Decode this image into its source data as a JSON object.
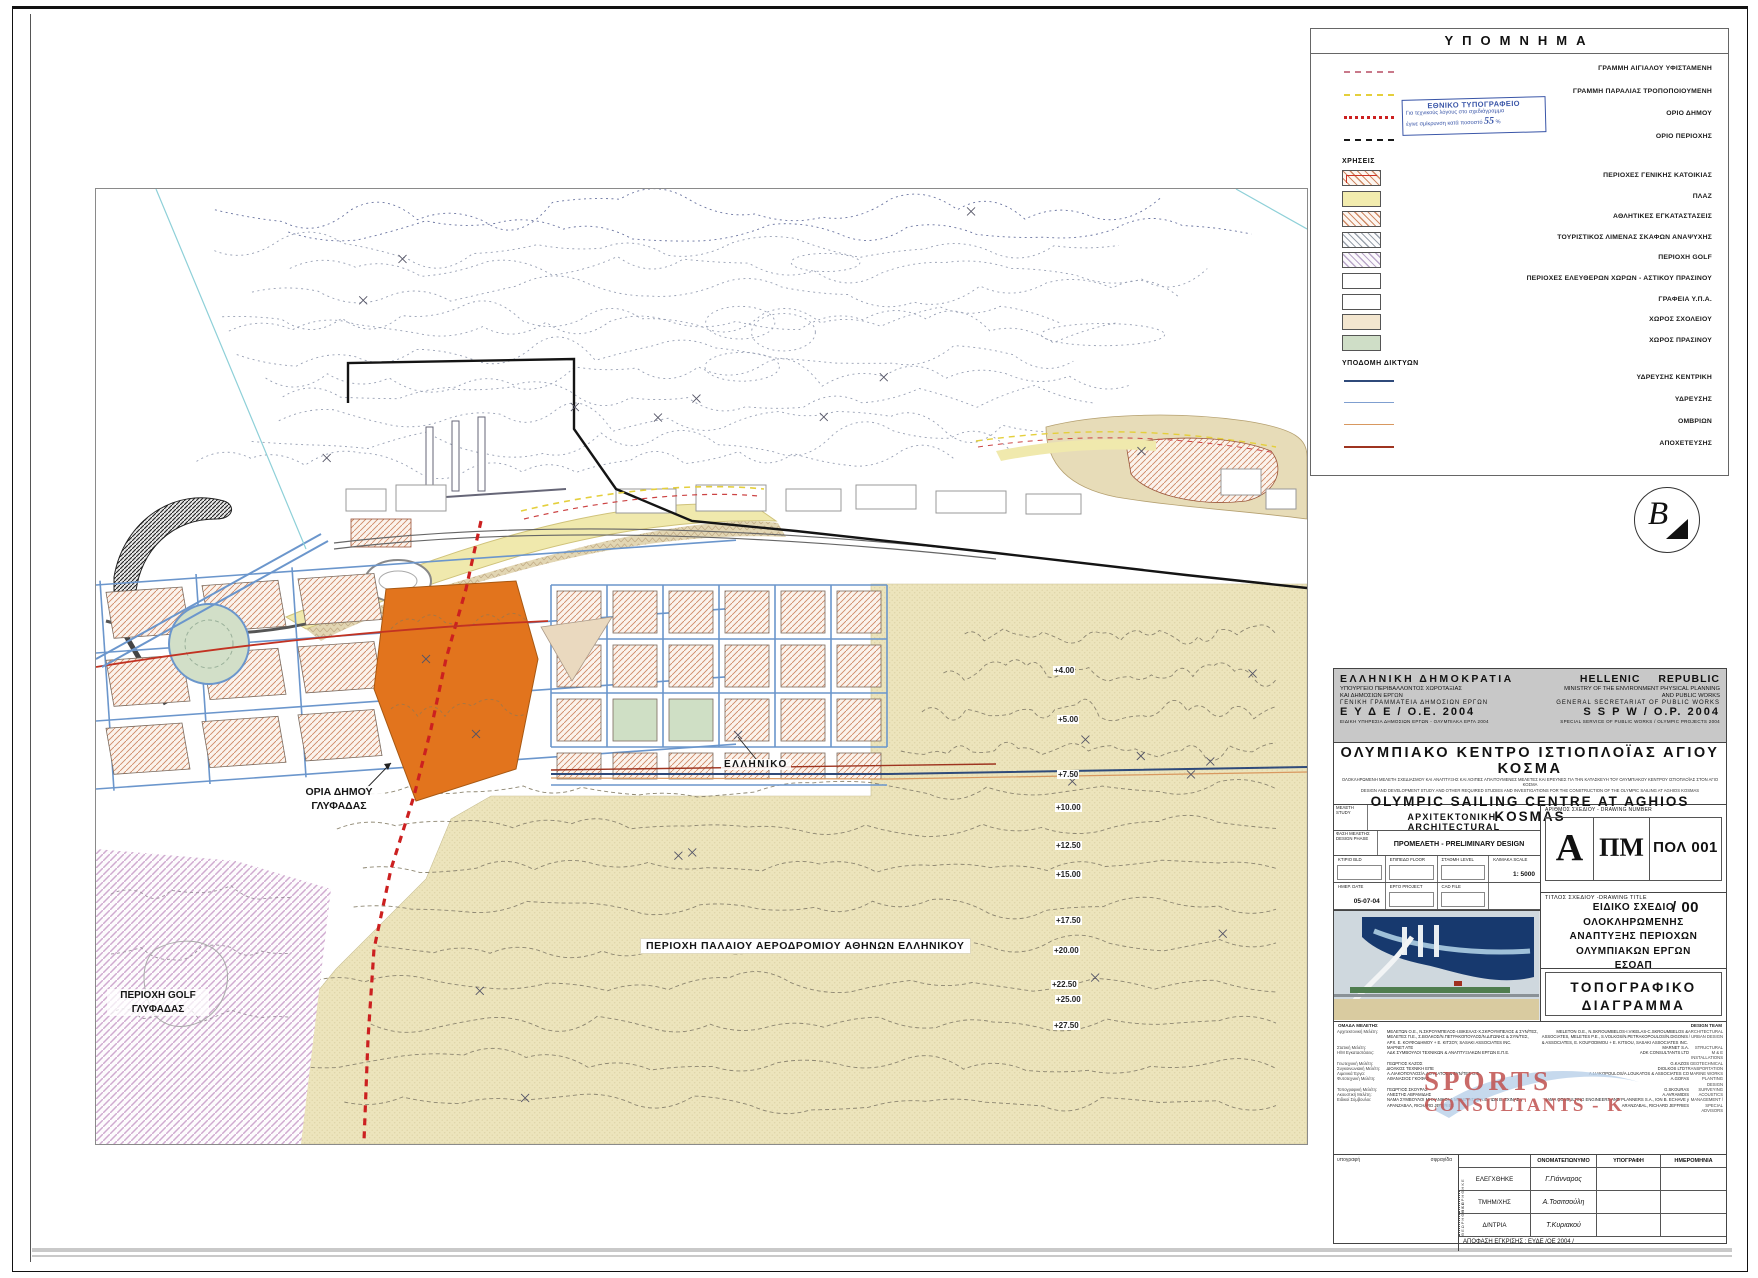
{
  "colors": {
    "accent_orange": "#e2741d",
    "stamp_blue": "#3a56a8",
    "logo_red": "#c0504d",
    "tan_area": "#ece4bc",
    "hatch_salmon": "#cf8a66",
    "street_blue": "#6b96cc",
    "boundary_red": "#cc2020"
  },
  "legend": {
    "title": "ΥΠΟΜΝΗΜΑ",
    "lines": [
      {
        "kind": "aigialos",
        "label": "ΓΡΑΜΜΗ ΑΙΓΙΑΛΟΥ ΥΦΙΣΤΑΜΕΝΗ"
      },
      {
        "kind": "paralia",
        "label": "ΓΡΑΜΜΗ ΠΑΡΑΛΙΑΣ ΤΡΟΠΟΠΟΙΟΥΜΕΝΗ"
      },
      {
        "kind": "dimou",
        "label": "ΟΡΙΟ ΔΗΜΟΥ"
      },
      {
        "kind": "periochis",
        "label": "ΟΡΙΟ ΠΕΡΙΟΧΗΣ"
      }
    ],
    "uses_title": "ΧΡΗΣΕΙΣ",
    "uses": [
      {
        "kind": "residential",
        "label": "ΠΕΡΙΟΧΕΣ ΓΕΝΙΚΗΣ ΚΑΤΟΙΚΙΑΣ"
      },
      {
        "kind": "plaz",
        "label": "ΠΛΑΖ"
      },
      {
        "kind": "sport",
        "label": "ΑΘΛΗΤΙΚΕΣ ΕΓΚΑΤΑΣΤΑΣΕΙΣ"
      },
      {
        "kind": "marina",
        "label": "ΤΟΥΡΙΣΤΙΚΟΣ ΛΙΜΕΝΑΣ ΣΚΑΦΩΝ ΑΝΑΨΥΧΗΣ"
      },
      {
        "kind": "golf",
        "label": "ΠΕΡΙΟΧΗ GOLF"
      },
      {
        "kind": "freespace",
        "label": "ΠΕΡΙΟΧΕΣ ΕΛΕΥΘΕΡΩΝ ΧΩΡΩΝ - ΑΣΤΙΚΟΥ ΠΡΑΣΙΝΟΥ"
      },
      {
        "kind": "ypa",
        "label": "ΓΡΑΦΕΙΑ Υ.Π.Α."
      },
      {
        "kind": "school",
        "label": "ΧΩΡΟΣ ΣΧΟΛΕΙΟΥ"
      },
      {
        "kind": "green",
        "label": "ΧΩΡΟΣ ΠΡΑΣΙΝΟΥ"
      }
    ],
    "networks_title": "ΥΠΟΔΟΜΗ ΔΙΚΤΥΩΝ",
    "networks": [
      {
        "kind": "water-main",
        "label": "ΥΔΡΕΥΣΗΣ ΚΕΝΤΡΙΚΗ"
      },
      {
        "kind": "water",
        "label": "ΥΔΡΕΥΣΗΣ"
      },
      {
        "kind": "storm",
        "label": "ΟΜΒΡΙΩΝ"
      },
      {
        "kind": "sewer",
        "label": "ΑΠΟΧΕΤΕΥΣΗΣ"
      }
    ]
  },
  "stamp": {
    "line1": "ΕΘΝΙΚΟ ΤΥΠΟΓΡΑΦΕΙΟ",
    "line2": "Για τεχνικούς λόγους στο σχεδιάγραμμα",
    "line3": "έγινε σμίκρυνση κατά ποσοστό",
    "value": "55",
    "percent": "%"
  },
  "logo_b": "B",
  "map": {
    "labels": {
      "oria1": "ΟΡΙΑ ΔΗΜΟΥ",
      "oria2": "ΓΛΥΦΑΔΑΣ",
      "elliniko": "ΕΛΛΗΝΙΚΟ",
      "airport": "ΠΕΡΙΟΧΗ ΠΑΛΑΙΟΥ ΑΕΡΟΔΡΟΜΙΟΥ ΑΘΗΝΩΝ ΕΛΛΗΝΙΚΟΥ",
      "golf1": "ΠΕΡΙΟΧΗ GOLF",
      "golf2": "ΓΛΥΦΑΔΑΣ"
    },
    "elevations": [
      {
        "label": "+4.00",
        "x": 958,
        "y": 478
      },
      {
        "label": "+5.00",
        "x": 962,
        "y": 527
      },
      {
        "label": "+7.50",
        "x": 962,
        "y": 582
      },
      {
        "label": "+10.00",
        "x": 960,
        "y": 615
      },
      {
        "label": "+12.50",
        "x": 960,
        "y": 653
      },
      {
        "label": "+15.00",
        "x": 960,
        "y": 682
      },
      {
        "label": "+17.50",
        "x": 960,
        "y": 728
      },
      {
        "label": "+20.00",
        "x": 958,
        "y": 758
      },
      {
        "label": "+22.50",
        "x": 956,
        "y": 792
      },
      {
        "label": "+25.00",
        "x": 960,
        "y": 807
      },
      {
        "label": "+27.50",
        "x": 958,
        "y": 833
      }
    ]
  },
  "tb": {
    "gr": {
      "l1": "ΕΛΛΗΝΙΚΗ ΔΗΜΟΚΡΑΤΙΑ",
      "l2": "ΥΠΟΥΡΓΕΙΟ ΠΕΡΙΒΑΛΛΟΝΤΟΣ ΧΩΡΟΤΑΞΙΑΣ",
      "l3": "ΚΑΙ ΔΗΜΟΣΙΩΝ ΕΡΓΩΝ",
      "l4": "ΓΕΝΙΚΗ ΓΡΑΜΜΑΤΕΙΑ ΔΗΜΟΣΙΩΝ ΕΡΓΩΝ",
      "l5": "Ε Υ Δ Ε / Ο.Ε. 2004",
      "l6": "ΕΙΔΙΚΗ ΥΠΗΡΕΣΙΑ ΔΗΜΟΣΙΩΝ ΕΡΓΩΝ - ΟΛΥΜΠΙΑΚΑ ΕΡΓΑ 2004"
    },
    "en": {
      "l1": "HELLENIC REPUBLIC",
      "l2": "MINISTRY OF THE ENVIRONMENT PHYSICAL PLANNING",
      "l3": "AND PUBLIC WORKS",
      "l4": "GENERAL SECRETARIAT OF PUBLIC WORKS",
      "l5": "S S P W  /  O.P. 2004",
      "l6": "SPECIAL SERVICE OF PUBLIC WORKS / OLYMPIC PROJECTS 2004"
    },
    "project_gr": "ΟΛΥΜΠΙΑΚΟ ΚΕΝΤΡΟ ΙΣΤΙΟΠΛΟΪΑΣ ΑΓΙΟΥ ΚΟΣΜΑ",
    "sub_gr": "ΟΛΟΚΛΗΡΩΜΕΝΗ ΜΕΛΕΤΗ ΣΧΕΔΙΑΣΜΟΥ ΚΑΙ ΑΝΑΠΤΥΞΗΣ ΚΑΙ ΛΟΙΠΕΣ ΑΠΑΙΤΟΥΜΕΝΕΣ ΜΕΛΕΤΕΣ ΚΑΙ ΕΡΕΥΝΕΣ ΓΙΑ ΤΗΝ ΚΑΤΑΣΚΕΥΗ ΤΟΥ ΟΛΥΜΠΙΑΚΟΥ ΚΕΝΤΡΟΥ ΙΣΤΙΟΠΛΟΪΑΣ ΣΤΟΝ ΑΓΙΟ ΚΟΣΜΑ",
    "sub_en": "DESIGN AND DEVELOPMENT STUDY AND OTHER REQUIRED STUDIES AND INVESTIGATIONS FOR THE CONSTRUCTION OF THE OLYMPIC SAILING AT AGHIOS KOSMAS",
    "project_en": "OLYMPIC SAILING CENTRE AT AGHIOS KOSMAS",
    "study_gr": "ΜΕΛΕΤΗ",
    "study_en": "STUDY",
    "study_value": "ΑΡΧΙΤΕΚΤΟΝΙΚΗ-ARCHITECTURAL",
    "phase_gr": "ΦΑΣΗ ΜΕΛΕΤΗΣ",
    "phase_en": "DESIGN PHASE",
    "phase_value": "ΠΡΟΜΕΛΕΤΗ - PRELIMINARY DESIGN",
    "bld_gr": "ΚΤΙΡΙΟ",
    "bld_en": "BLD",
    "floor_gr": "ΕΠΙΠΕΔΟ",
    "floor_en": "FLOOR",
    "level_gr": "ΣΤΑΘΜΗ",
    "level_en": "LEVEL",
    "scale_gr": "ΚΛΙΜΑΚΑ",
    "scale_en": "SCALE",
    "scale_value": "1: 5000",
    "date_gr": "ΗΜΕΡ.",
    "date_en": "DATE",
    "date_value": "05-07-04",
    "proj_gr": "ΕΡΓΟ",
    "proj_en": "PROJECT",
    "cad": "CAD FILE",
    "num_label": "ΑΡΙΘΜΟΣ ΣΧΕΔΙΟΥ - DRAWING NUMBER",
    "num_a": "Α",
    "num_pm": "ΠΜ",
    "num_code": "ΠΟΛ 001 / 00",
    "ttl_label": "ΤΙΤΛΟΣ ΣΧΕΔΙΟΥ -DRAWING TITLE",
    "ttl1": "ΕΙΔΙΚΟ ΣΧΕΔΙΟ ΟΛΟΚΛΗΡΩΜΕΝΗΣ",
    "ttl2": "ΑΝΑΠΤΥΞΗΣ ΠΕΡΙΟΧΩΝ",
    "ttl3": "ΟΛΥΜΠΙΑΚΩΝ ΕΡΓΩΝ",
    "ttl4": "ΕΣΟΑΠ",
    "type1": "ΤΟΠΟΓΡΑΦΙΚΟ",
    "type2": "ΔΙΑΓΡΑΜΜΑ"
  },
  "team": {
    "header_gr": "ΟΜΑΔΑ ΜΕΛΕΤΗΣ",
    "header_en": "DESIGN TEAM",
    "logo1": "SPORTS",
    "logo2": "CONSULTANTS - K",
    "rows": [
      {
        "lab": "Αρχιτεκτονική Μελέτη:",
        "gr": "ΜΕΛΕΤΩΝ Ο.Ε., Ν.ΣΚΡΟΥΜΠΕΛΟΣ-Ι.ΒΙΚΕΛΑΣ-Χ.ΣΚΡΟΥΜΠΕΛΟΣ & ΣΥΝ/ΤΕΣ, ΜΕΛΕΤΕΣ Π.Ε., Σ.ΒΟΛΚΟΣ/Ν.ΠΕΤΡΑΚΟΠΟΥΛΟΣ/Ν.ΔΙΓΩΝΗΣ & ΣΥΝ/ΤΕΣ, ΑΡΧ. Ε. ΚΟΥΦΟΔΗΜΟΥ + Ε. ΚΙΤΣΟΥ, SASAKI ASSOCIATES INC.",
        "en": "MELETON O.E., N.SKROUMBELOS-I.VIKELAS-C.SKROUMBELOS & ASSOCIATES, MELETES P.E., S.VOLKOS/N.PETRAKOPOULOS/N.DIGONIS & ASSOCIATES, E. KOUFODIMOU + E. KITSOU, SASAKI ASSOCIATES INC.",
        "dis": "ARCHITECTURAL / URBAN DESIGN"
      },
      {
        "lab": "Στατική Μελέτη:",
        "gr": "ΜΑΡΝΕΤ ΑΤΕ",
        "en": "MARNET S.A.",
        "dis": "STRUCTURAL"
      },
      {
        "lab": "Η/Μ Εγκαταστάσεις:",
        "gr": "ΑΔΚ ΣΥΜΒΟΥΛΟΙ ΤΕΧΝΙΚΩΝ & ΑΝΑΠΤΥΞΙΑΚΩΝ ΕΡΓΩΝ Ε.Π.Ε.",
        "en": "ADK CONSULTANTS LTD",
        "dis": "M & E INSTALLATIONS"
      },
      {
        "lab": "Γεωτεχνική Μελέτη:",
        "gr": "ΓΕΩΡΓΙΟΣ ΚΑΖΟΣ",
        "en": "G.KAZOS",
        "dis": "GEOTECHNICAL"
      },
      {
        "lab": "Συγκοινωνιακή Μελέτη:",
        "gr": "ΔΙΟΛΚΟΣ ΤΕΧΝΙΚΗ ΕΠΕ",
        "en": "DIOLKOS LTD",
        "dis": "TRANSPORTATION"
      },
      {
        "lab": "Λιμενικά Έργα:",
        "gr": "Α.ΛΙΑΚΟΠΟΥΛΟΣ/Α.ΛΟΥΚΑΤΟΣ & ΣΥΝ/ΤΕΣ Ο.Ε.",
        "en": "A.LIAKOPOULOS/A.LOUKATOS & ASSOCIATES CO",
        "dis": "MARINE WORKS"
      },
      {
        "lab": "Φυτοτεχνική Μελέτη:",
        "gr": "ΑΘΑΝΑΣΙΟΣ ΓΚΟΦΑΣ",
        "en": "A.GOFAS",
        "dis": "PLANTING DESIGN"
      },
      {
        "lab": "Τοπογραφική Μελέτη:",
        "gr": "ΓΕΩΡΓΙΟΣ ΣΚΟΥΡΑΣ",
        "en": "G.SKOURAS",
        "dis": "SURVEYING"
      },
      {
        "lab": "Ακουστική Μελέτη:",
        "gr": "ΑΝΕΣΤΗΣ ΑΒΡΑΜΙΔΗΣ",
        "en": "A.AVRAMIDIS",
        "dis": "ACOUSTICS"
      },
      {
        "lab": "Ειδικοί Σύμβουλοι:",
        "gr": "ΝΑΜΑ ΣΥΜΒΟΥΛΟΙ ΜΗΧΑΝΙΚΟΙ & ΜΕΛΕΤΗΤΕΣ Α.Ε., ΙΩΝ Β. ΣΧΙΝΑΣ γ ΑΡΑΝΖΑΒΑΛ, RICHARD JEFFRIES",
        "en": "NAMA CONSULTING ENGINEERS AND PLANNERS S.A., ION B. ECHAVE y ARANZABAL, RICHARD JEFFRIES",
        "dis": "MANAGEMENT / SPECIAL ADVISORS"
      }
    ]
  },
  "signature": {
    "left_top": "υπογραφή",
    "left_top2": "σφραγίδα",
    "col_name": "ΟΝΟΜΑΤΕΠΩΝΥΜΟ",
    "col_sig": "ΥΠΟΓΡΑΦΗ",
    "col_date": "ΗΜΕΡΟΜΗΝΙΑ",
    "vertical": "ΘΕΩΡΗΘΗΚΕ",
    "rows": [
      {
        "role": "ΕΛΕΓΧΘΗΚΕ",
        "name": "Γ.Γιάνναρος"
      },
      {
        "role": "ΤΜΗΜ/ΧΗΣ",
        "name": "Α.Τοσιτσούλη"
      },
      {
        "role": "Δ/ΝΤΡΙΑ",
        "name": "Τ.Κυριακού"
      }
    ],
    "approval": "ΑΠΟΦΑΣΗ ΕΓΚΡΙΣΗΣ : ΕΥΔΕ /ΟΕ 2004 /"
  }
}
